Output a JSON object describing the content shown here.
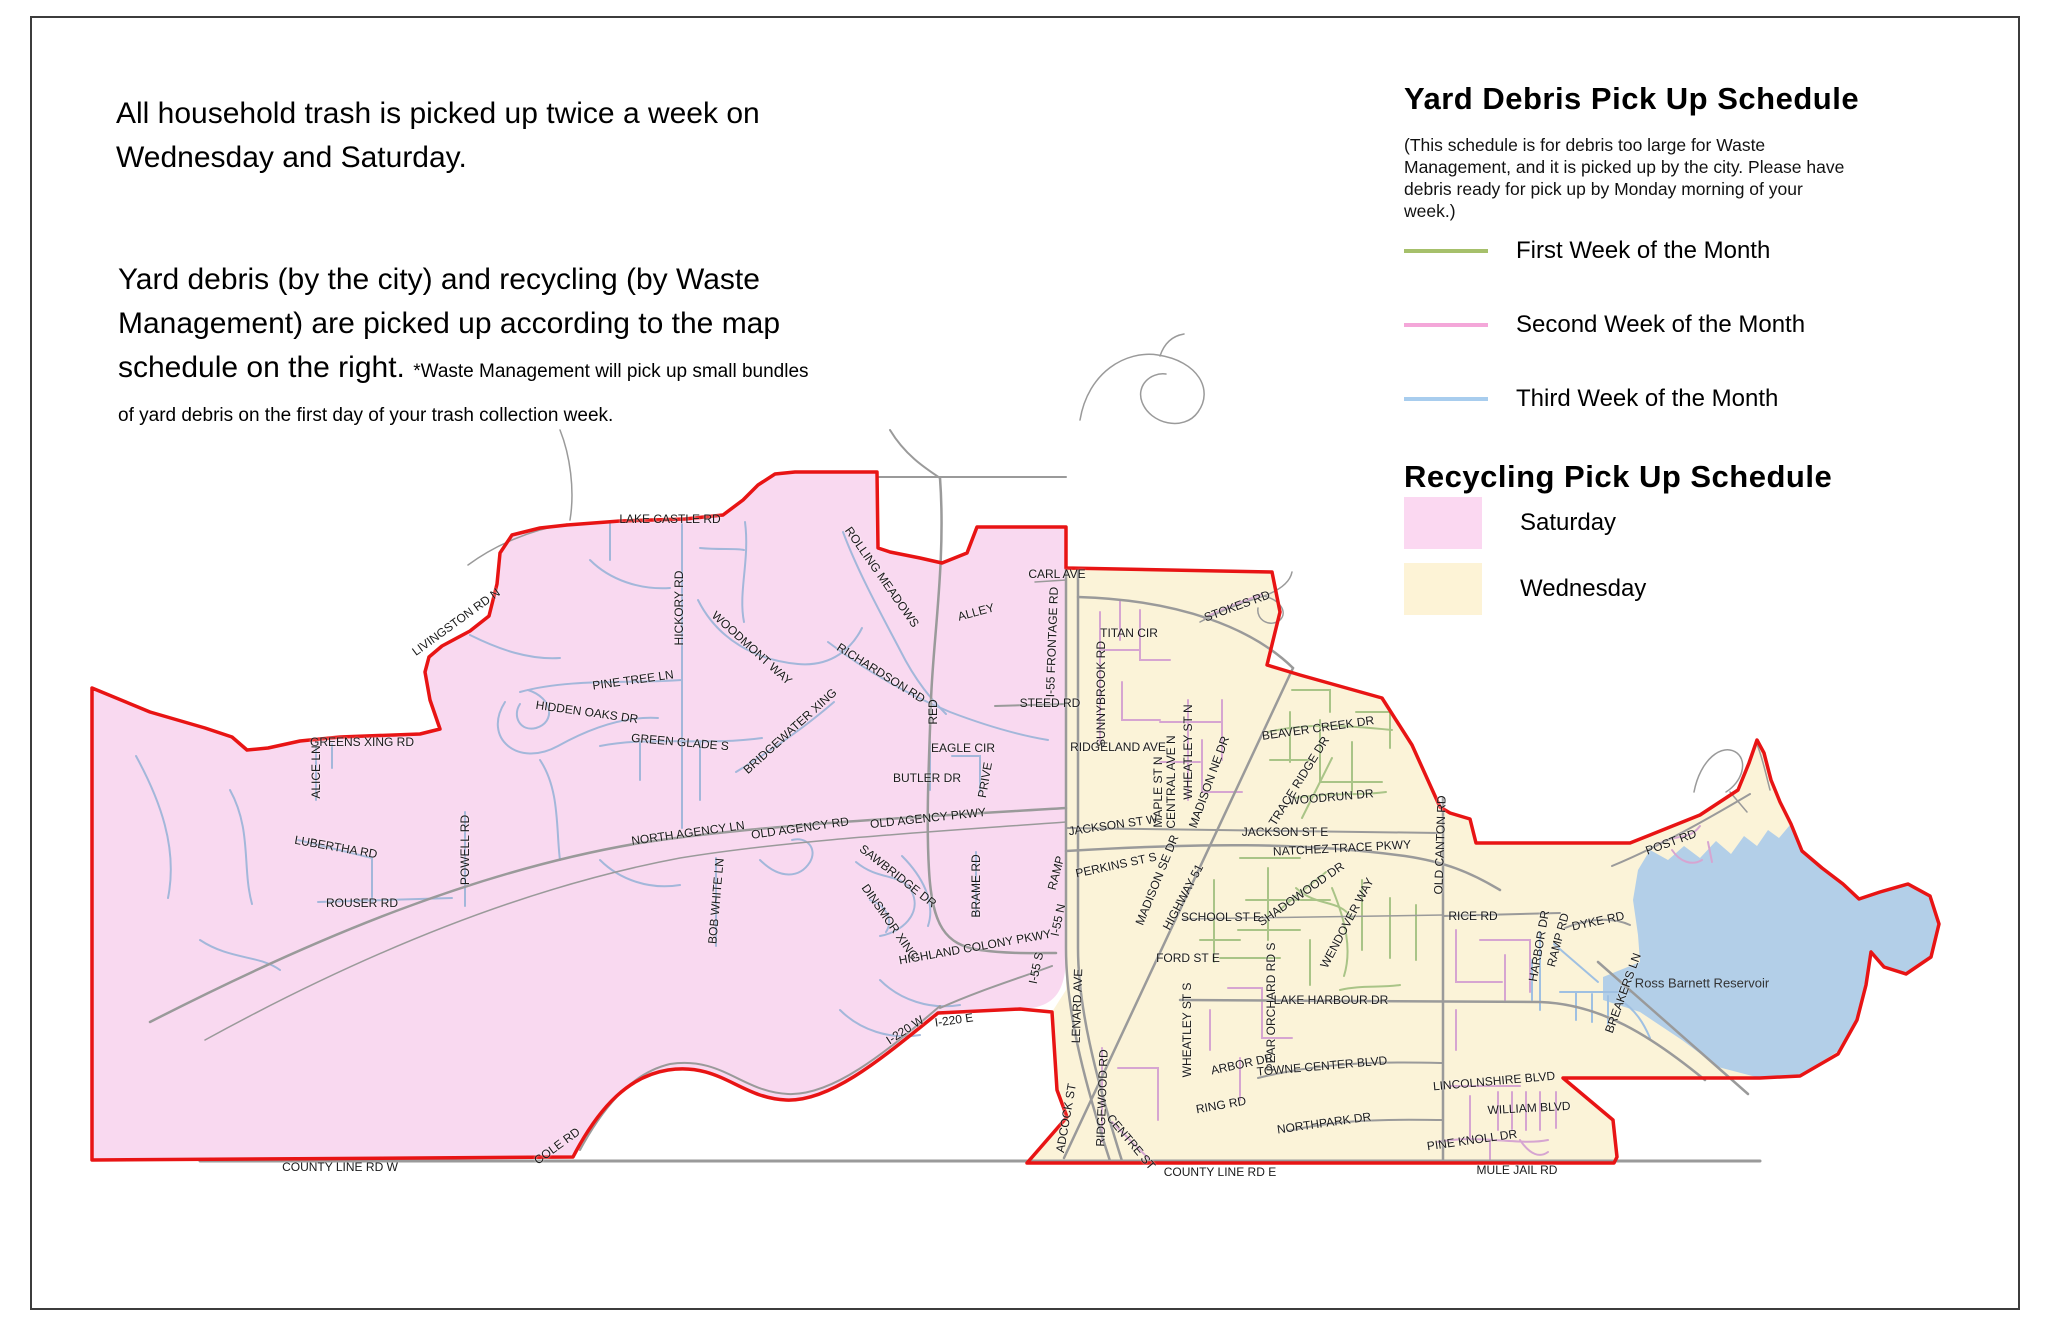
{
  "intro": {
    "paragraph1": "All household trash is picked up twice a week on Wednesday and Saturday.",
    "paragraph2": "Yard debris (by the city) and recycling (by Waste Management) are picked up according to the map schedule on the right.",
    "note": "*Waste Management will pick up small bundles of yard debris on the first day of your trash collection week."
  },
  "yard_schedule": {
    "title": "Yard Debris Pick Up Schedule",
    "note": "(This schedule is for debris too large for Waste Management, and it is picked up by the city. Please have debris ready for pick up by Monday morning of your week.)",
    "items": [
      {
        "label": "First Week of the Month",
        "color": "#a6c06b"
      },
      {
        "label": "Second Week of the Month",
        "color": "#f4a7d9"
      },
      {
        "label": "Third Week of the Month",
        "color": "#a8cdee"
      }
    ]
  },
  "recycling_schedule": {
    "title": "Recycling Pick Up Schedule",
    "zones": [
      {
        "label": "Saturday",
        "color": "#fbd8f1"
      },
      {
        "label": "Wednesday",
        "color": "#fdf3d6"
      }
    ]
  },
  "map": {
    "water_body": "Ross Barnett Reservoir",
    "colors": {
      "saturday_zone": "#f9d9f0",
      "wednesday_zone": "#fbf3d8",
      "water": "#b3cfe8",
      "boundary": "#e81414",
      "major_road": "#9a9a9a",
      "street_blue": "#a3b7da",
      "street_pink": "#d6a5d1",
      "street_green": "#a9c487",
      "street_water": "#9fc0e2",
      "label_text": "#1a1a1a"
    },
    "labels": [
      {
        "t": "LAKE CASTLE RD",
        "x": 670,
        "y": 519,
        "r": 0
      },
      {
        "t": "LIVINGSTON RD N",
        "x": 456,
        "y": 622,
        "r": -36
      },
      {
        "t": "HICKORY RD",
        "x": 679,
        "y": 608,
        "r": -90
      },
      {
        "t": "ROLLING MEADOWS",
        "x": 882,
        "y": 577,
        "r": 55
      },
      {
        "t": "PINE TREE LN",
        "x": 633,
        "y": 680,
        "r": -8
      },
      {
        "t": "HIDDEN OAKS DR",
        "x": 587,
        "y": 712,
        "r": 8
      },
      {
        "t": "WOODMONT WAY",
        "x": 752,
        "y": 648,
        "r": 42
      },
      {
        "t": "GREEN GLADE S",
        "x": 680,
        "y": 742,
        "r": 5
      },
      {
        "t": "BRIDGEWATER XING",
        "x": 790,
        "y": 731,
        "r": -42
      },
      {
        "t": "RICHARDSON RD",
        "x": 881,
        "y": 673,
        "r": 32
      },
      {
        "t": "GREENS XING RD",
        "x": 362,
        "y": 742,
        "r": 0
      },
      {
        "t": "ALICE LN",
        "x": 316,
        "y": 772,
        "r": -90
      },
      {
        "t": "LUBERTHA RD",
        "x": 336,
        "y": 847,
        "r": 10
      },
      {
        "t": "POWELL RD",
        "x": 465,
        "y": 850,
        "r": -90
      },
      {
        "t": "ROUSER RD",
        "x": 362,
        "y": 903,
        "r": 0
      },
      {
        "t": "NORTH AGENCY LN",
        "x": 688,
        "y": 833,
        "r": -8
      },
      {
        "t": "OLD AGENCY RD",
        "x": 800,
        "y": 828,
        "r": -8
      },
      {
        "t": "OLD AGENCY PKWY",
        "x": 928,
        "y": 818,
        "r": -6
      },
      {
        "t": "BOB WHITE LN",
        "x": 716,
        "y": 901,
        "r": -85
      },
      {
        "t": "SAWBRIDGE DR",
        "x": 898,
        "y": 876,
        "r": 38
      },
      {
        "t": "DINSMOR XING",
        "x": 890,
        "y": 922,
        "r": 55
      },
      {
        "t": "BRAME RD",
        "x": 976,
        "y": 886,
        "r": -90
      },
      {
        "t": "HIGHLAND COLONY PKWY",
        "x": 975,
        "y": 947,
        "r": -10
      },
      {
        "t": "RAMP",
        "x": 1056,
        "y": 873,
        "r": -75
      },
      {
        "t": "I-55 N",
        "x": 1058,
        "y": 920,
        "r": -78
      },
      {
        "t": "I-55 S",
        "x": 1036,
        "y": 968,
        "r": -78
      },
      {
        "t": "I-220 W",
        "x": 905,
        "y": 1030,
        "r": -33
      },
      {
        "t": "I-220 E",
        "x": 954,
        "y": 1020,
        "r": -8
      },
      {
        "t": "COLE RD",
        "x": 557,
        "y": 1146,
        "r": -36
      },
      {
        "t": "COUNTY LINE RD W",
        "x": 340,
        "y": 1167,
        "r": 0
      },
      {
        "t": "BUTLER DR",
        "x": 927,
        "y": 778,
        "r": 0
      },
      {
        "t": "EAGLE CIR",
        "x": 963,
        "y": 748,
        "r": 0
      },
      {
        "t": "PRIVE",
        "x": 985,
        "y": 780,
        "r": -80
      },
      {
        "t": "RED",
        "x": 933,
        "y": 712,
        "r": -90
      },
      {
        "t": "ALLEY",
        "x": 976,
        "y": 612,
        "r": -15
      },
      {
        "t": "STEED RD",
        "x": 1050,
        "y": 703,
        "r": 0
      },
      {
        "t": "CARL AVE",
        "x": 1057,
        "y": 574,
        "r": 0
      },
      {
        "t": "I-55 FRONTAGE RD",
        "x": 1052,
        "y": 642,
        "r": -88
      },
      {
        "t": "STOKES RD",
        "x": 1237,
        "y": 606,
        "r": -20
      },
      {
        "t": "TITAN CIR",
        "x": 1129,
        "y": 633,
        "r": 0
      },
      {
        "t": "SUNNYBROOK RD",
        "x": 1101,
        "y": 694,
        "r": -90
      },
      {
        "t": "RIDGELAND AVE",
        "x": 1118,
        "y": 747,
        "r": 0
      },
      {
        "t": "MAPLE ST N",
        "x": 1158,
        "y": 792,
        "r": -90
      },
      {
        "t": "CENTRAL AVE N",
        "x": 1171,
        "y": 782,
        "r": -90
      },
      {
        "t": "WHEATLEY ST N",
        "x": 1188,
        "y": 752,
        "r": -90
      },
      {
        "t": "MADISON NE DR",
        "x": 1209,
        "y": 782,
        "r": -70
      },
      {
        "t": "JACKSON ST W",
        "x": 1113,
        "y": 825,
        "r": -8
      },
      {
        "t": "MADISON SE DR",
        "x": 1157,
        "y": 880,
        "r": -68
      },
      {
        "t": "HIGHWAY 51",
        "x": 1183,
        "y": 897,
        "r": -62
      },
      {
        "t": "PERKINS ST S",
        "x": 1116,
        "y": 865,
        "r": -12
      },
      {
        "t": "BEAVER CREEK DR",
        "x": 1318,
        "y": 728,
        "r": -8
      },
      {
        "t": "TRACE RIDGE DR",
        "x": 1299,
        "y": 781,
        "r": -58
      },
      {
        "t": "WOODRUN DR",
        "x": 1331,
        "y": 797,
        "r": -5
      },
      {
        "t": "JACKSON ST E",
        "x": 1285,
        "y": 832,
        "r": 0
      },
      {
        "t": "NATCHEZ TRACE PKWY",
        "x": 1342,
        "y": 848,
        "r": -3
      },
      {
        "t": "OLD CANTON RD",
        "x": 1440,
        "y": 845,
        "r": -88
      },
      {
        "t": "SCHOOL ST E",
        "x": 1221,
        "y": 917,
        "r": 0
      },
      {
        "t": "FORD ST E",
        "x": 1188,
        "y": 958,
        "r": 0
      },
      {
        "t": "SHADOWOOD DR",
        "x": 1301,
        "y": 894,
        "r": -35
      },
      {
        "t": "WENDOVER WAY",
        "x": 1347,
        "y": 923,
        "r": -62
      },
      {
        "t": "WHEATLEY ST S",
        "x": 1187,
        "y": 1030,
        "r": -90
      },
      {
        "t": "PEAR ORCHARD RD S",
        "x": 1271,
        "y": 1007,
        "r": -90
      },
      {
        "t": "LAKE HARBOUR DR",
        "x": 1331,
        "y": 1000,
        "r": 0
      },
      {
        "t": "ARBOR DR",
        "x": 1242,
        "y": 1064,
        "r": -12
      },
      {
        "t": "TOWNE CENTER BLVD",
        "x": 1322,
        "y": 1066,
        "r": -5
      },
      {
        "t": "RING RD",
        "x": 1221,
        "y": 1105,
        "r": -10
      },
      {
        "t": "RIDGEWOOD RD",
        "x": 1102,
        "y": 1098,
        "r": -88
      },
      {
        "t": "CENTRE ST",
        "x": 1131,
        "y": 1142,
        "r": 50
      },
      {
        "t": "ADCOCK ST",
        "x": 1066,
        "y": 1118,
        "r": -80
      },
      {
        "t": "LENARD AVE",
        "x": 1077,
        "y": 1006,
        "r": -88
      },
      {
        "t": "NORTHPARK DR",
        "x": 1324,
        "y": 1123,
        "r": -8
      },
      {
        "t": "COUNTY LINE RD E",
        "x": 1220,
        "y": 1172,
        "r": 0
      },
      {
        "t": "RICE RD",
        "x": 1473,
        "y": 916,
        "r": 0
      },
      {
        "t": "LINCOLNSHIRE BLVD",
        "x": 1494,
        "y": 1081,
        "r": -5
      },
      {
        "t": "WILLIAM BLVD",
        "x": 1529,
        "y": 1108,
        "r": -3
      },
      {
        "t": "PINE KNOLL DR",
        "x": 1472,
        "y": 1140,
        "r": -8
      },
      {
        "t": "MULE JAIL RD",
        "x": 1517,
        "y": 1170,
        "r": 0
      },
      {
        "t": "DYKE RD",
        "x": 1598,
        "y": 921,
        "r": -12
      },
      {
        "t": "HARBOR DR",
        "x": 1539,
        "y": 946,
        "r": -80
      },
      {
        "t": "RAMP RD",
        "x": 1558,
        "y": 940,
        "r": -75
      },
      {
        "t": "BREAKERS LN",
        "x": 1623,
        "y": 993,
        "r": -70
      },
      {
        "t": "POST RD",
        "x": 1671,
        "y": 842,
        "r": -20
      },
      {
        "t": "Ross Barnett Reservoir",
        "x": 1702,
        "y": 983,
        "r": 0,
        "s": 13
      }
    ]
  }
}
